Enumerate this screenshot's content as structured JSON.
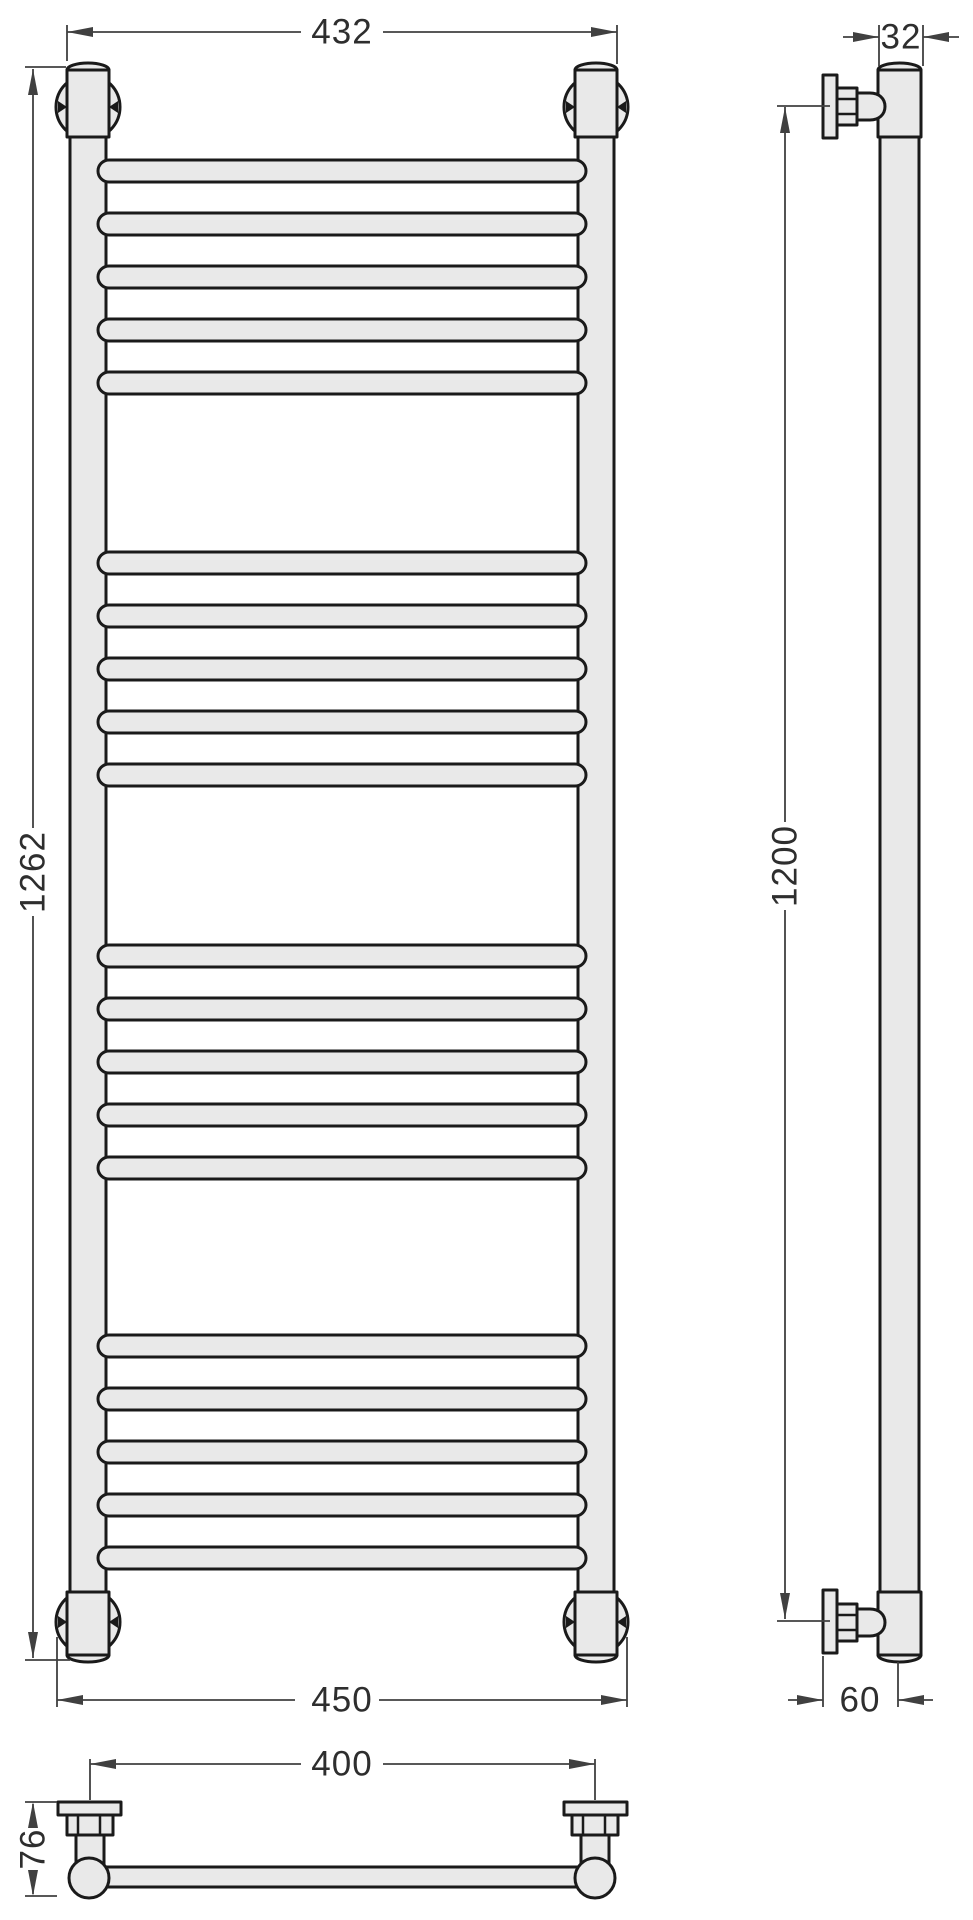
{
  "drawing": {
    "dims": {
      "front_width_top": "432",
      "front_height": "1262",
      "front_width_bottom": "450",
      "side_tube_diameter": "32",
      "side_mount_height": "1200",
      "side_wall_offset": "60",
      "bottom_mount_spacing": "400",
      "bottom_depth": "76"
    },
    "colors": {
      "outline": "#1a1a1a",
      "part_fill": "#e9e9e9",
      "dimension": "#404040",
      "background": "#ffffff"
    }
  }
}
